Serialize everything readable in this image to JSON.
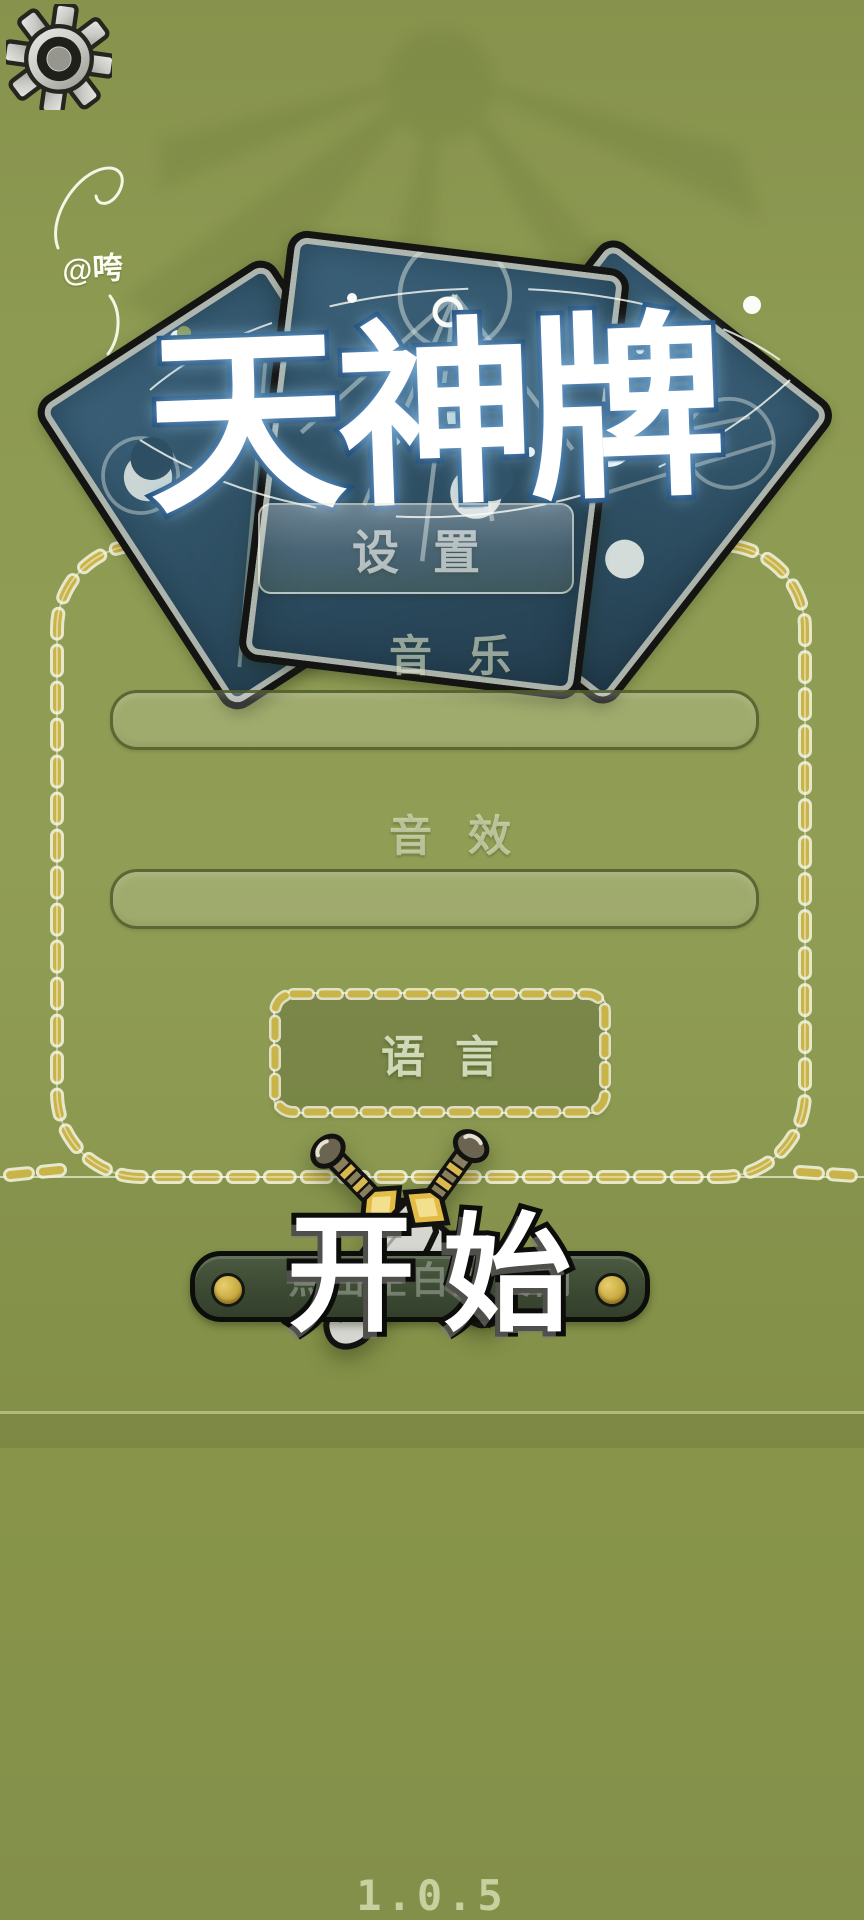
{
  "title": {
    "text": "天神牌"
  },
  "watermark": {
    "text": "@咵"
  },
  "settings_overlay": {
    "title": "设置",
    "music_label": "音乐",
    "sfx_label": "音效",
    "language_label": "语言",
    "close_hint": "点击空白处关闭"
  },
  "start_button": {
    "label": "开始"
  },
  "version": "1.0.5",
  "icons": {
    "top_left": "gear-icon"
  },
  "colors": {
    "background": "#8d9a52",
    "vine_gold": "#c9b44a",
    "card_face": "#2f5266",
    "title_stroke": "#1c4a78",
    "start_bar": "#3c4a33",
    "gold_dot": "#c3a239"
  }
}
